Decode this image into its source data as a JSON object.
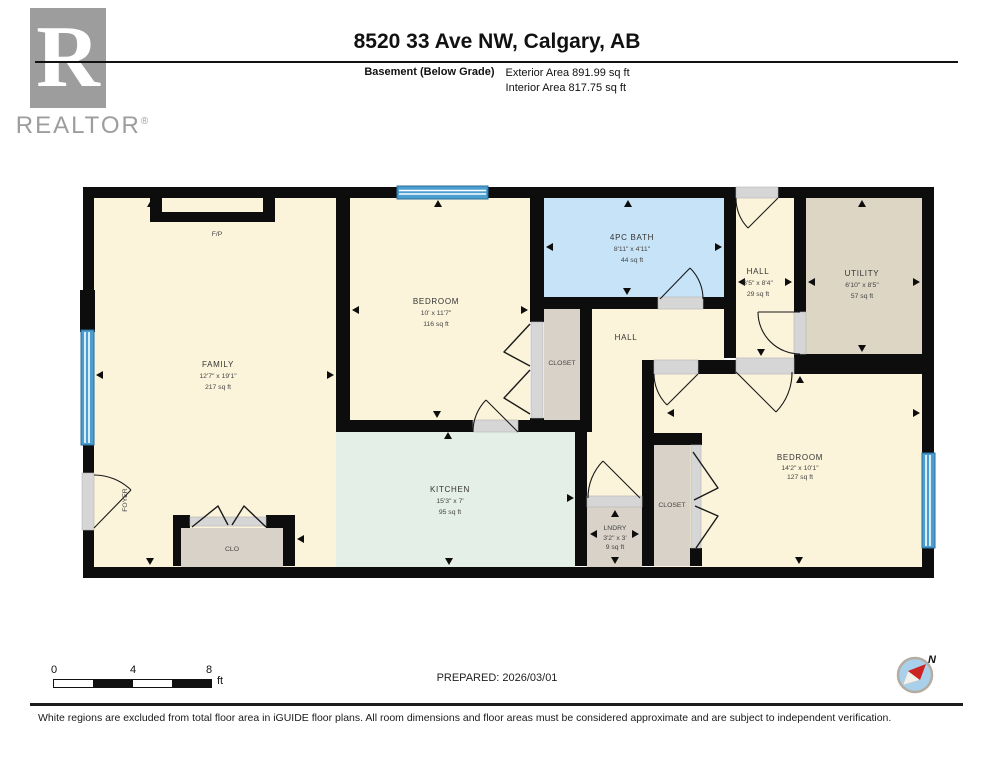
{
  "header": {
    "logo_r": "R",
    "logo_text": "REALTOR",
    "logo_reg": "®",
    "title": "8520 33 Ave NW, Calgary, AB",
    "floor_label": "Basement (Below Grade)",
    "exterior_area": "Exterior Area 891.99 sq ft",
    "interior_area": "Interior Area 817.75 sq ft"
  },
  "colors": {
    "cream": "#fbf4da",
    "mint": "#e4efe7",
    "bath_blue": "#c6e3f7",
    "utility_taupe": "#ddd6c5",
    "closet_grey": "#d9d2c8",
    "wall_black": "#0d0d0d",
    "window_blue": "#4a9ed2",
    "sill_grey": "#d6d6d6"
  },
  "rooms": {
    "family": {
      "name": "FAMILY",
      "dims": "12'7\" x 19'1\"",
      "area": "217 sq ft"
    },
    "foyer": {
      "name": "FOYER"
    },
    "fireplace": {
      "name": "F/P"
    },
    "clo": {
      "name": "CLO"
    },
    "bedroom_mid": {
      "name": "BEDROOM",
      "dims": "10' x 11'7\"",
      "area": "116 sq ft"
    },
    "closet_mid": {
      "name": "CLOSET"
    },
    "bath": {
      "name": "4PC BATH",
      "dims": "8'11\" x 4'11\"",
      "area": "44 sq ft"
    },
    "hall_small": {
      "name": "HALL",
      "dims": "3'5\" x 8'4\"",
      "area": "29 sq ft"
    },
    "utility": {
      "name": "UTILITY",
      "dims": "6'10\" x 8'5\"",
      "area": "57 sq ft"
    },
    "hall_center": {
      "name": "HALL"
    },
    "kitchen": {
      "name": "KITCHEN",
      "dims": "15'3\" x 7'",
      "area": "95 sq ft"
    },
    "laundry": {
      "name": "LNDRY",
      "dims": "3'2\" x 3'",
      "area": "9 sq ft"
    },
    "closet_right": {
      "name": "CLOSET"
    },
    "bedroom_right": {
      "name": "BEDROOM",
      "dims": "14'2\" x 10'1\"",
      "area": "127 sq ft"
    }
  },
  "scale_bar": {
    "ticks": [
      "0",
      "4",
      "8"
    ],
    "unit": "ft"
  },
  "bottom": {
    "prepared": "PREPARED: 2026/03/01",
    "compass_n": "N"
  },
  "footer": {
    "disclaimer": "White regions are excluded from total floor area in iGUIDE floor plans. All room dimensions and floor areas must be considered approximate and are subject to independent verification."
  }
}
